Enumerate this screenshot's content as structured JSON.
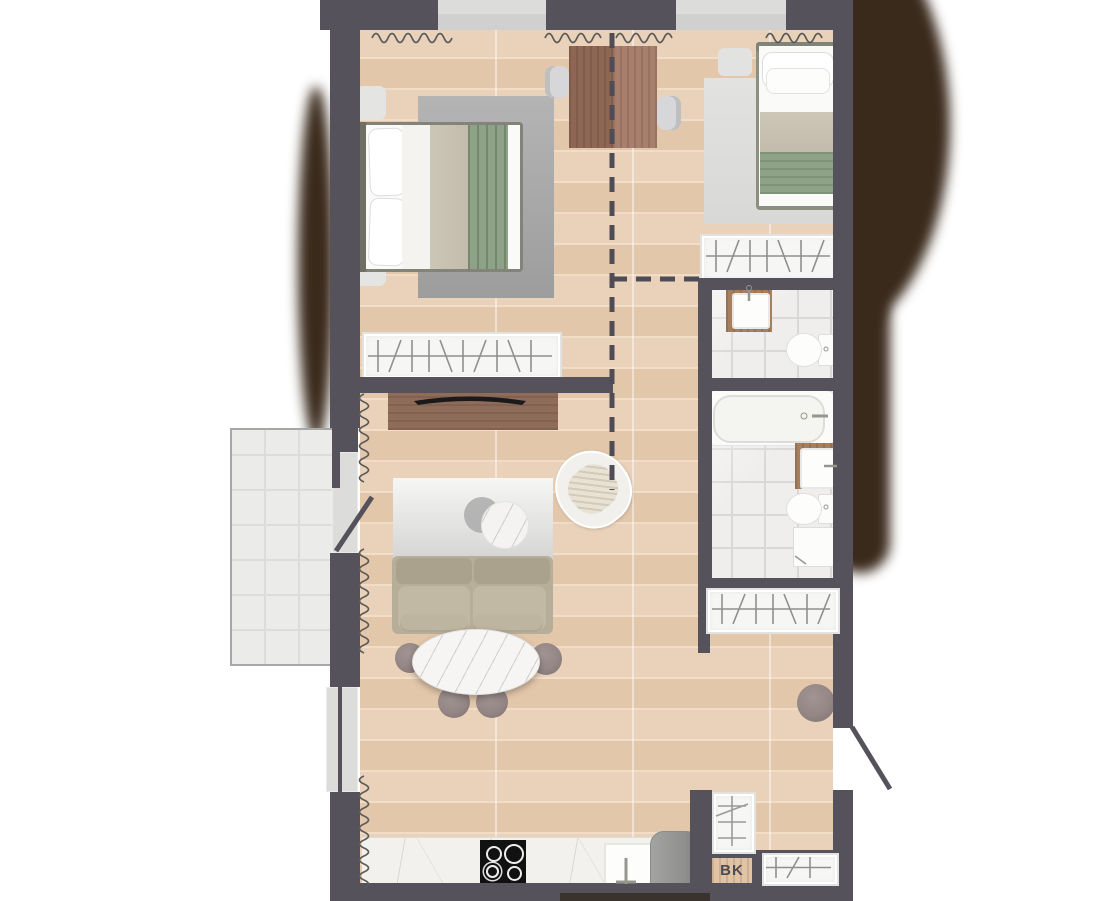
{
  "labels": {
    "bk": "BK"
  },
  "palette": {
    "wall": "#55525b",
    "window": "#dcdcda",
    "shadow_blob": "#3a2a1c",
    "floor_wood": "#e8cfb6",
    "balcony_tile": "#ebebe9",
    "marble": "#efeeec",
    "wood_furniture": "#a57f5e",
    "dining_table_dark": "#8d6753",
    "dining_table_light": "#a87f6d",
    "tv_board": "#8f6b59",
    "green_textile": "#8da287",
    "beige_textile": "#c8c1b1",
    "sofa": "#b7ae99",
    "rug_gray": "#a8a8a8",
    "rug_light": "#dfdfdd",
    "pouf": "#8f8281",
    "white_fixture": "#fbfbf9",
    "hob": "#111111",
    "fridge": "#979795"
  },
  "plan": {
    "type": "apartment-floor-plan",
    "rooms": [
      {
        "name": "bedroom-1",
        "furniture": [
          "double-bed",
          "pillows",
          "rug",
          "nightstand",
          "nightstand",
          "wardrobe",
          "radiator"
        ]
      },
      {
        "name": "dining-area",
        "furniture": [
          "dining-table",
          "chair",
          "chair"
        ]
      },
      {
        "name": "bedroom-2",
        "furniture": [
          "single-bed",
          "rug",
          "nightstand",
          "wardrobe",
          "radiator"
        ]
      },
      {
        "name": "wc",
        "furniture": [
          "washbasin-vanity",
          "toilet"
        ]
      },
      {
        "name": "bathroom",
        "furniture": [
          "bathtub",
          "washbasin-vanity",
          "toilet",
          "washing-machine"
        ]
      },
      {
        "name": "hallway",
        "furniture": [
          "wardrobe",
          "round-pouf",
          "shelf-unit",
          "entry-door"
        ]
      },
      {
        "name": "storage-closet",
        "label": "BK",
        "furniture": [
          "shelf-unit",
          "wardrobe"
        ]
      },
      {
        "name": "living-room",
        "furniture": [
          "tv-sideboard",
          "tv",
          "rug",
          "sofa",
          "coffee-table",
          "pouf",
          "pouf",
          "pouf",
          "pouf",
          "armchair",
          "side-table"
        ]
      },
      {
        "name": "kitchen",
        "furniture": [
          "countertop",
          "cooktop",
          "sink",
          "fridge",
          "radiator"
        ]
      },
      {
        "name": "balcony",
        "furniture": [
          "balcony-door"
        ]
      }
    ],
    "annotations": [
      "dashed-partition-lines",
      "door-swing-lines",
      "radiator-squiggles",
      "wardrobe-hanging-hatch"
    ]
  }
}
